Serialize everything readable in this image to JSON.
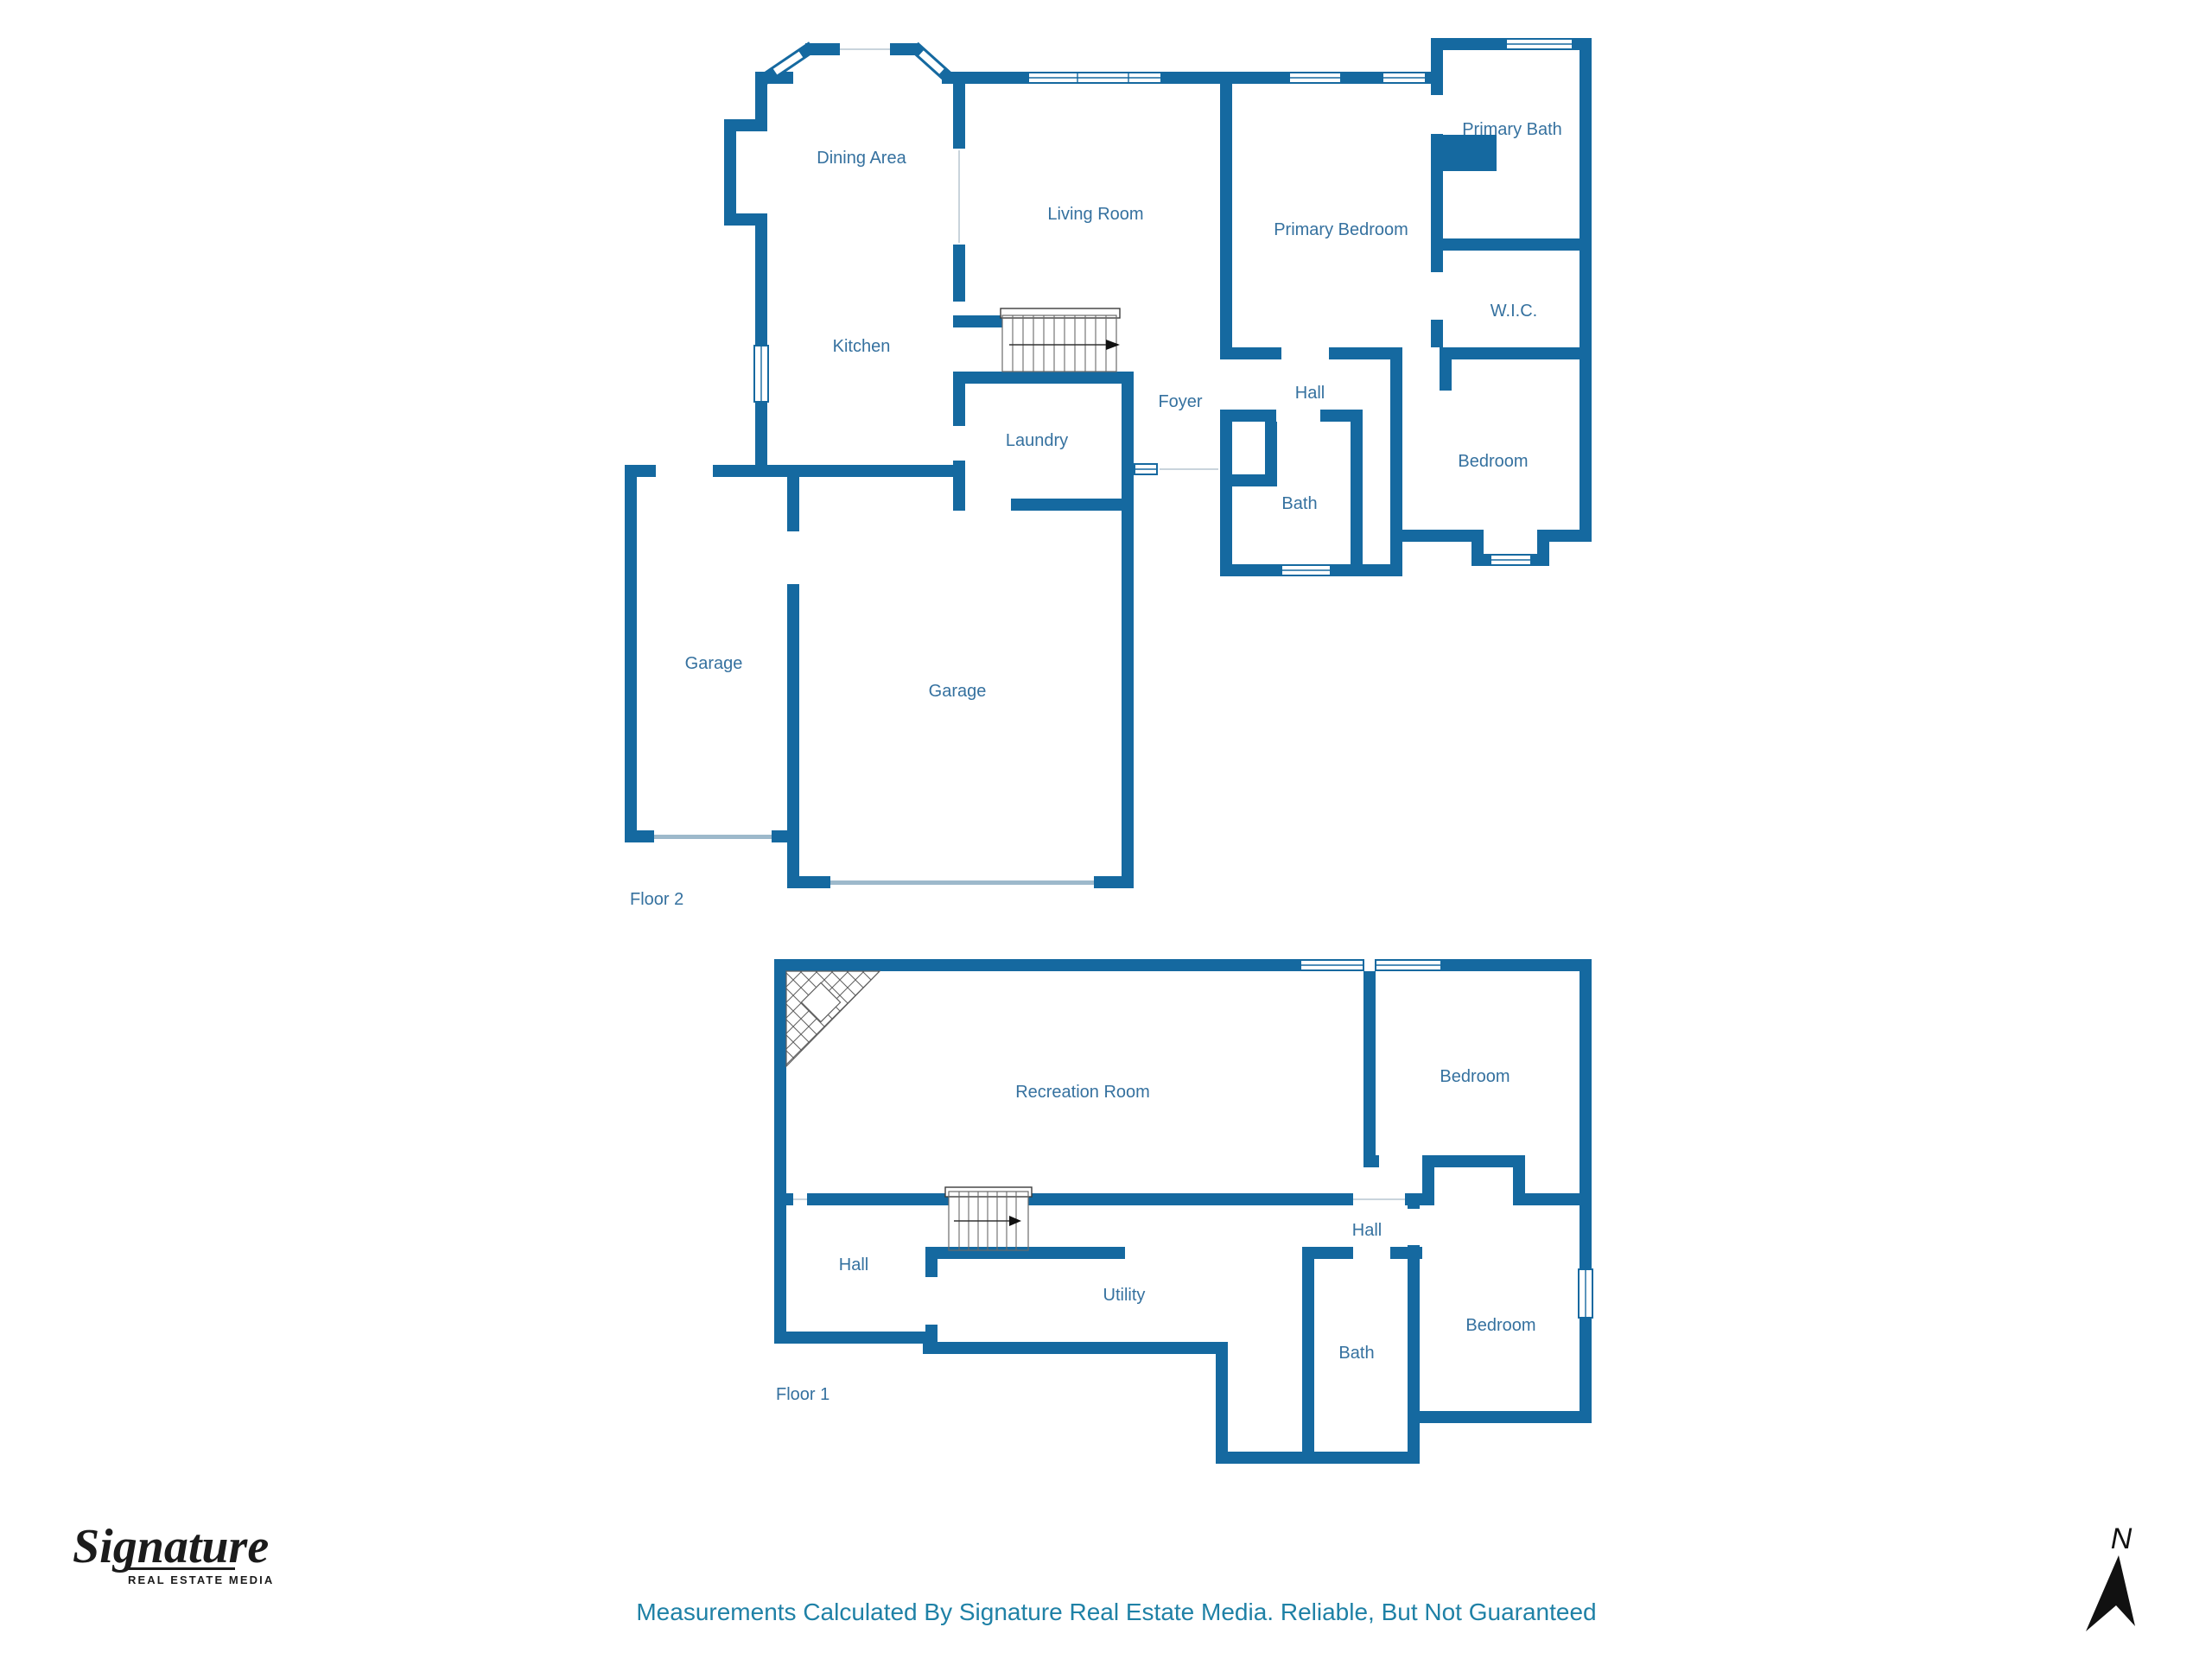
{
  "colors": {
    "wall_blue": "#1569a0",
    "room_label_blue": "#35719f",
    "footer_teal": "#1f81a6",
    "logo_black": "#1b1b1b",
    "stair_line_gray": "#6a6a6a"
  },
  "floor2": {
    "floor_label": "Floor 2",
    "rooms": {
      "dining": "Dining Area",
      "kitchen": "Kitchen",
      "living": "Living Room",
      "primary_bedroom": "Primary Bedroom",
      "primary_bath": "Primary Bath",
      "wic": "W.I.C.",
      "hall": "Hall",
      "foyer": "Foyer",
      "laundry": "Laundry",
      "bath": "Bath",
      "bedroom": "Bedroom",
      "garage_left": "Garage",
      "garage_right": "Garage"
    }
  },
  "floor1": {
    "floor_label": "Floor 1",
    "rooms": {
      "recreation": "Recreation Room",
      "bedroom_upper": "Bedroom",
      "hall_right": "Hall",
      "hall_left": "Hall",
      "utility": "Utility",
      "bath": "Bath",
      "bedroom_lower": "Bedroom"
    }
  },
  "footer": {
    "disclaimer": "Measurements Calculated By Signature Real Estate Media. Reliable, But Not Guaranteed"
  },
  "logo": {
    "brand_script": "Signature",
    "brand_sub": "REAL ESTATE MEDIA"
  },
  "compass": {
    "north_label": "N"
  }
}
